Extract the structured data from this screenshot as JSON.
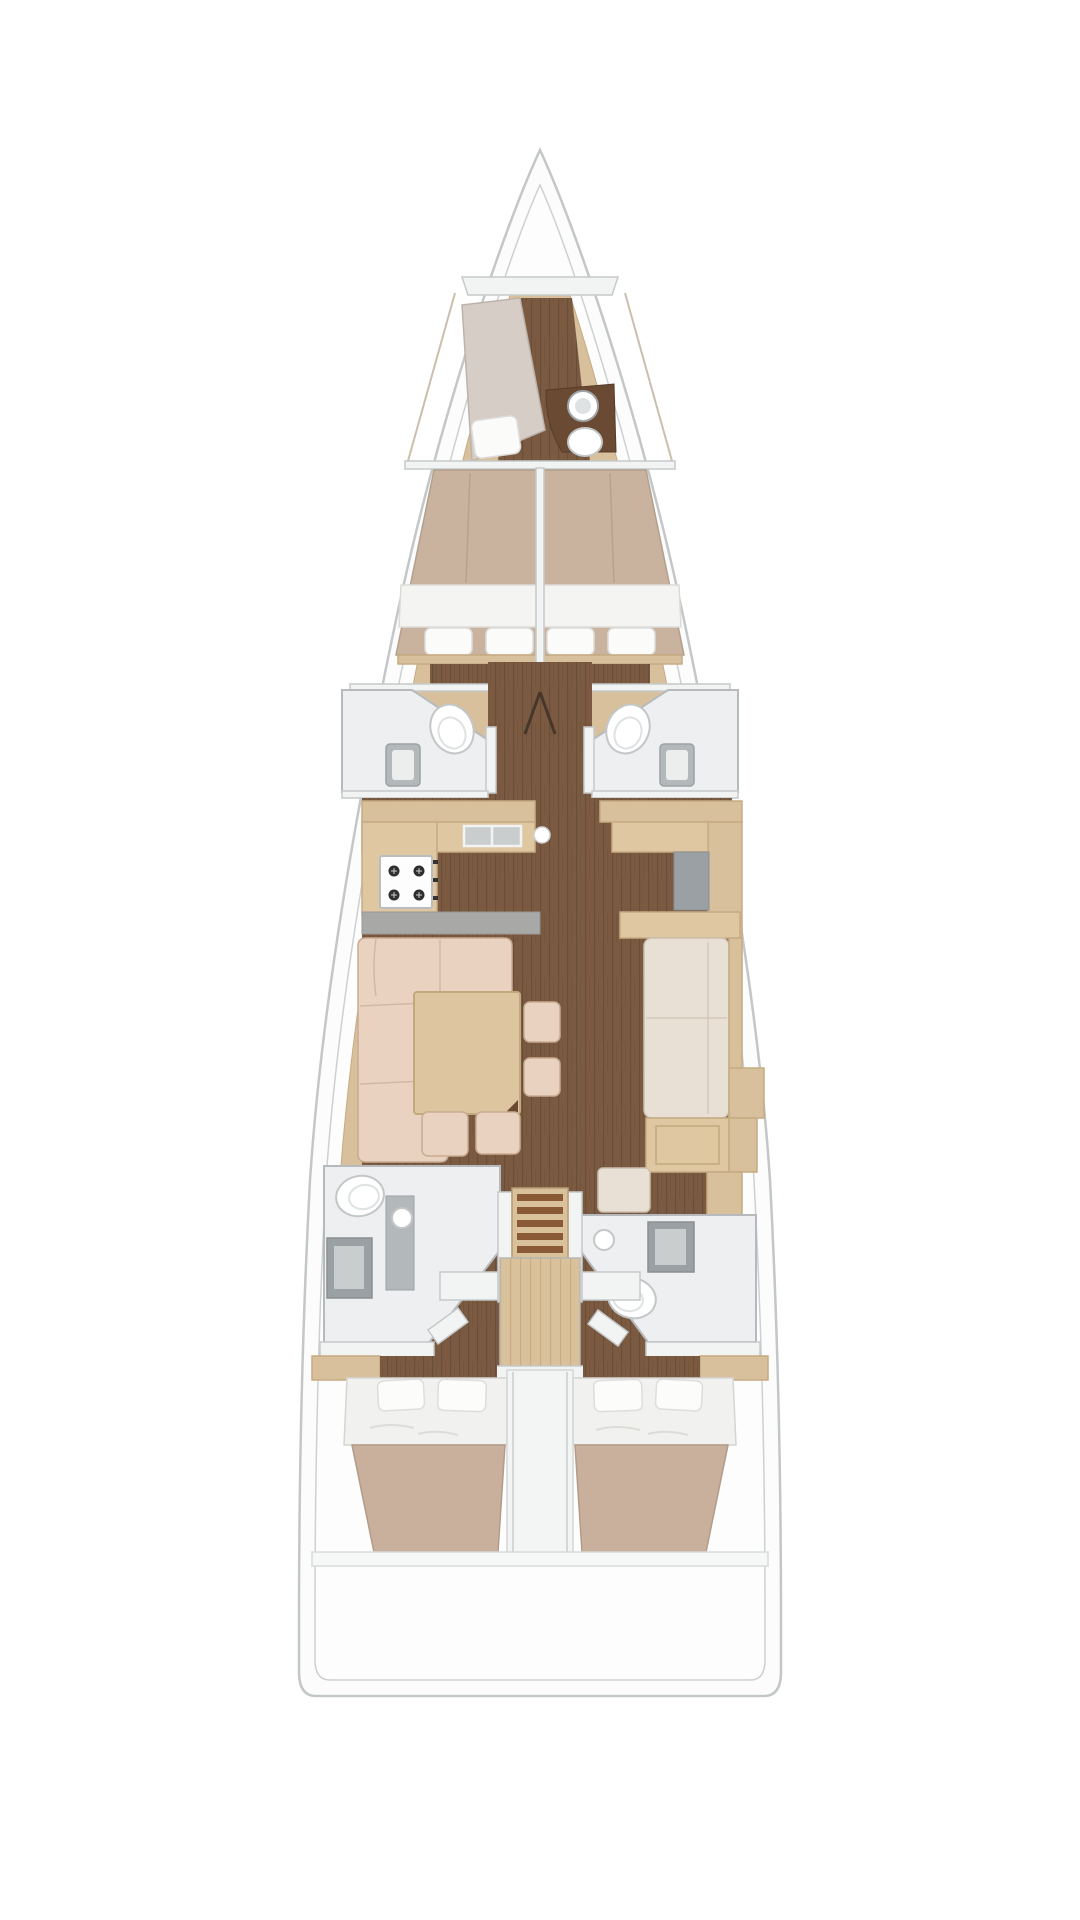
{
  "meta": {
    "type": "yacht-interior-floor-plan",
    "view": "top-down",
    "orientation": "bow-at-top",
    "canvas": {
      "width": 1080,
      "height": 1920
    }
  },
  "palette": {
    "background": "#ffffff",
    "hull_deck": "#fcfcfc",
    "hull_line": "#c3c7c8",
    "joinery_wood": "#d8c09c",
    "counter_wood": "#dfc7a1",
    "table_wood": "#ddc5a0",
    "ladder_wood": "#d9c19b",
    "dark_wood": "#6a4a33",
    "floor_teak": "#7c5a41",
    "floor_teak_stripe": "#66503a",
    "upholstery_cream": "#e9d3c0",
    "settee_cream": "#e8e0d4",
    "mattress_taupe": "#c9b29e",
    "berth_gray": "#d5cdc6",
    "linen_white": "#f4f4f2",
    "bathroom_floor": "#edeff0",
    "fixture_gray": "#9aa0a3",
    "countertop_gray": "#a8a8a6",
    "wall_white": "#f2f3f3",
    "wall_line": "#c6c9ca"
  },
  "areas": {
    "bow_deck": {
      "label": "Bow deck"
    },
    "skipper_cabin": {
      "label": "Skipper cabin with single berth, washbasin and toilet"
    },
    "forward_cabin_port": {
      "label": "Forward port cabin with double berth"
    },
    "forward_cabin_stbd": {
      "label": "Forward starboard cabin with double berth"
    },
    "head_forward_port": {
      "label": "Forward port head with toilet and washbasin"
    },
    "head_forward_stbd": {
      "label": "Forward starboard head with toilet and washbasin"
    },
    "mast_corridor": {
      "label": "Central corridor with mast support"
    },
    "galley": {
      "label": "Galley with 4-burner stove and double sink"
    },
    "saloon": {
      "label": "Saloon with L-sofa, dining table and stools"
    },
    "nav_station": {
      "label": "Navigation station"
    },
    "settee_starboard": {
      "label": "Starboard settee"
    },
    "head_aft_port": {
      "label": "Aft port head with toilet, washbasin and shower"
    },
    "head_aft_stbd": {
      "label": "Aft starboard head with shower, toilet and washbasin"
    },
    "companionway": {
      "label": "Companionway ladder"
    },
    "aft_cabin_port": {
      "label": "Aft port cabin with double berth"
    },
    "aft_cabin_stbd": {
      "label": "Aft starboard cabin with double berth"
    },
    "stern_transom": {
      "label": "Stern transom"
    }
  },
  "features": {
    "cabins": 5,
    "heads": 4,
    "stove_burners": 4,
    "ladder_steps": 5,
    "dinette_stools": 4,
    "forward_bed_pillows": 4,
    "aft_bed_pillows": 4
  }
}
